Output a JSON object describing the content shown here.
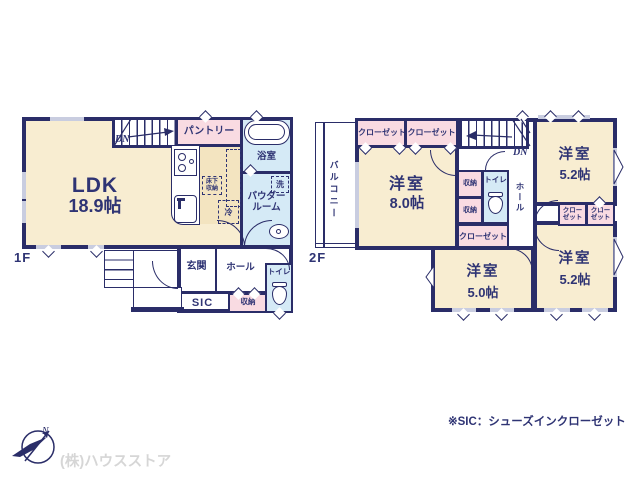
{
  "colors": {
    "wall": "#2a2d68",
    "txt": "#2f3474",
    "cream": "#f8edd1",
    "tan": "#f3e4c0",
    "pink": "#f9dbe2",
    "blue": "#d5eaf6",
    "wgray": "#c9cde0",
    "fgray": "#d6d6d6"
  },
  "floor1": {
    "label": "1F",
    "dn": "DN",
    "ldk": {
      "name": "LDK",
      "size": "18.9帖"
    },
    "pantry": "パントリー",
    "bath": "浴室",
    "washer": "洗",
    "powder_line1": "パウダー",
    "powder_line2": "ルーム",
    "underfloor_line1": "床下",
    "underfloor_line2": "収納",
    "fridge": "冷",
    "entrance": "玄関",
    "hall": "ホール",
    "sic": "SIC",
    "storage": "収納",
    "toilet": "トイレ"
  },
  "floor2": {
    "label": "2F",
    "dn": "DN",
    "balcony": "バルコニー",
    "hall": "ホール",
    "toilet": "トイレ",
    "closet_top_a": "クローゼット",
    "closet_top_b": "クローゼット",
    "closet_c": "クローゼット",
    "closet_small_line1": "クロー",
    "closet_small_line2": "ゼット",
    "storage_a": "収納",
    "storage_b": "収納",
    "rooms": {
      "main": {
        "name": "洋室",
        "size": "8.0帖"
      },
      "ne": {
        "name": "洋室",
        "size": "5.2帖"
      },
      "s": {
        "name": "洋室",
        "size": "5.0帖"
      },
      "se": {
        "name": "洋室",
        "size": "5.2帖"
      }
    }
  },
  "footer": {
    "company": "(株)ハウスストア",
    "note": "※SIC：シューズインクローゼット"
  },
  "compass": {
    "north": "N"
  }
}
